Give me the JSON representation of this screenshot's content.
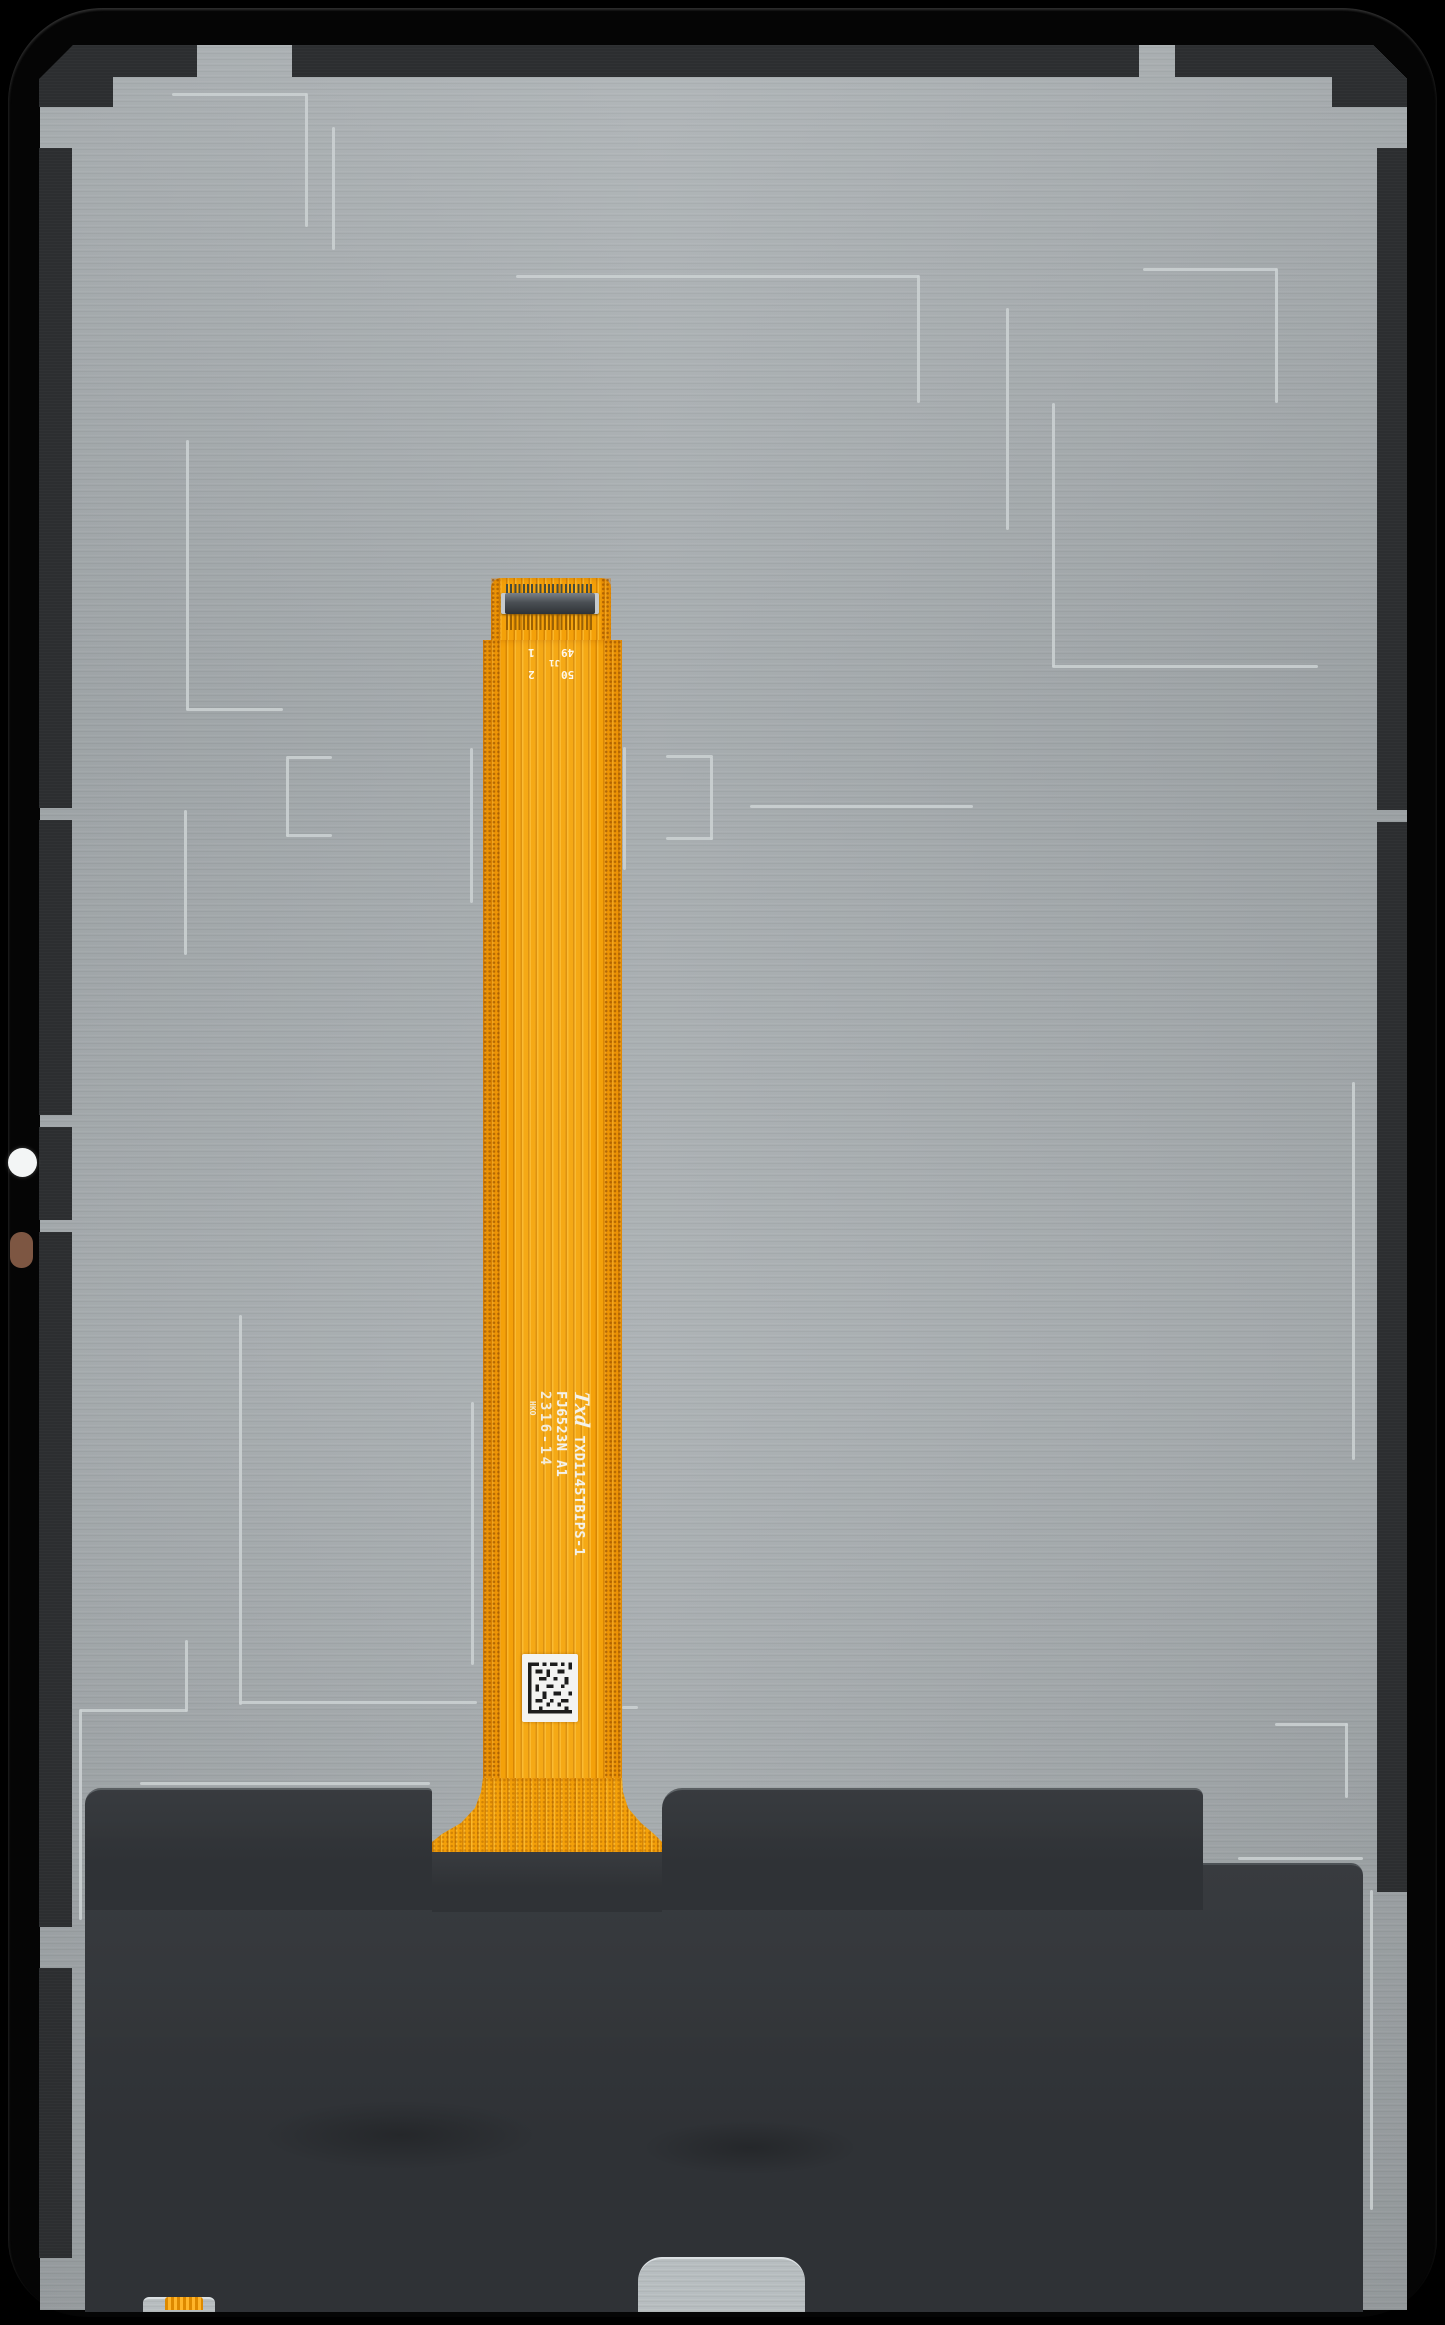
{
  "subject": {
    "description": "Tablet LCD display assembly, rear view, with long orange main flex ribbon cable"
  },
  "flex_cable": {
    "logo": "Txd",
    "part_number": "TXD1145TBIPS-1",
    "model_code": "FJ6523N A1",
    "date_code": "2316-14",
    "factory_code": "HKO",
    "connector_labels": {
      "designator": "J1",
      "pin1": "1",
      "pin2": "2",
      "pin49": "49",
      "pin50": "50"
    }
  },
  "colors": {
    "frame_black": "#050505",
    "plate_gray": "#a6acaf",
    "strip_charcoal": "#2c2e30",
    "cover_charcoal": "#323539",
    "flex_orange": "#f4a008",
    "etch_line": "#ccd2d4",
    "label_white": "#f3f2ec",
    "copper_brown": "#7d5642"
  }
}
